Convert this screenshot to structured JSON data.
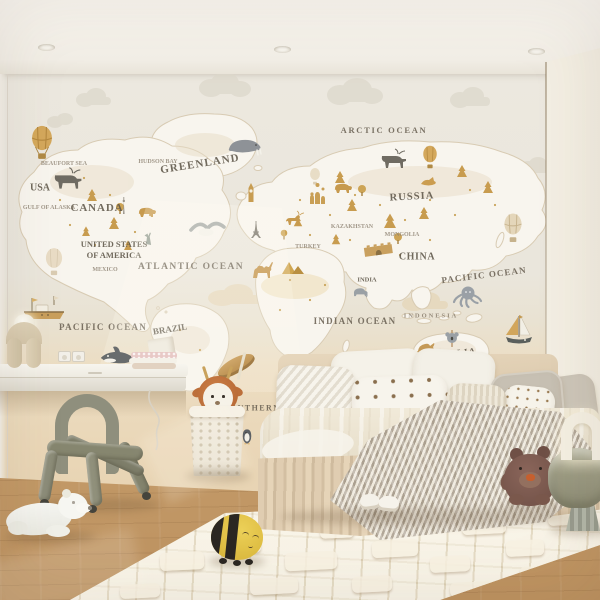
{
  "scene": {
    "description": "Children's bedroom photo: world-map mural wallpaper, bed with knit blanket, floating desk, tube chair, plush toys",
    "palette": {
      "ceiling": "#f4f1ea",
      "wall_sky": "#eae6dc",
      "wall_sand": "#e8d5b4",
      "right_wall": "#f4f0e7",
      "floor_wood": "#c9a173",
      "rug": "#ebe2cf",
      "map_land": "#f8f5ee",
      "map_gold": "#c89c4f",
      "map_grey": "#8f9398",
      "map_text": "#5f574a",
      "bed_beige": "#dcc9ae",
      "chair_olive": "#8d8d79",
      "table_sage": "#98977f",
      "teddy_brown": "#7c594b",
      "bee_yellow": "#e0be41",
      "deer_hood_orange": "#bc6f3a"
    }
  },
  "map": {
    "labels": {
      "arctic_ocean": "Arctic Ocean",
      "greenland": "Greenland",
      "usa": "USA",
      "canada": "Canada",
      "united_states_line1": "United States",
      "united_states_line2": "of America",
      "atlantic_ocean": "Atlantic Ocean",
      "pacific_ocean_left": "Pacific Ocean",
      "pacific_ocean_right": "Pacific Ocean",
      "southern_ocean": "Southern Ocean",
      "indian_ocean": "Indian Ocean",
      "russia": "Russia",
      "china": "China",
      "mongolia": "Mongolia",
      "kazakhstan": "Kazakhstan",
      "turkey": "Turkey",
      "india": "India",
      "indonesia": "Indonesia",
      "australia": "Australia",
      "brazil": "Brazil",
      "mexico": "Mexico",
      "beaufort_sea": "Beaufort Sea",
      "gulf_of_alaska": "Gulf of Alaska",
      "hudson_bay": "Hudson Bay"
    },
    "illustrations": [
      "hot-air-balloon",
      "walrus",
      "moose",
      "bear",
      "pine-tree",
      "round-tree",
      "statue-of-liberty",
      "cn-tower",
      "big-ben",
      "eiffel-tower",
      "st-basil-cathedral",
      "great-wall",
      "camel",
      "pyramids",
      "deer",
      "fox",
      "tern",
      "elephant",
      "octopus",
      "sailboat",
      "fishing-boat",
      "kangaroo",
      "koala",
      "orca",
      "penguin",
      "cloud"
    ]
  },
  "room": {
    "objects": [
      "recessed-spotlight",
      "floating-desk",
      "wall-outlets",
      "book-stack",
      "sculptural-lamp",
      "tube-chair",
      "knit-laundry-basket",
      "deer-plush",
      "toy-canoe",
      "polar-bear-plush",
      "bee-plush",
      "baby-shoes",
      "bed",
      "throw-pillows",
      "chevron-knit-blanket",
      "teddy-bear-plush",
      "sage-side-table",
      "arch-lamp",
      "embossed-rug",
      "oak-floor"
    ]
  }
}
